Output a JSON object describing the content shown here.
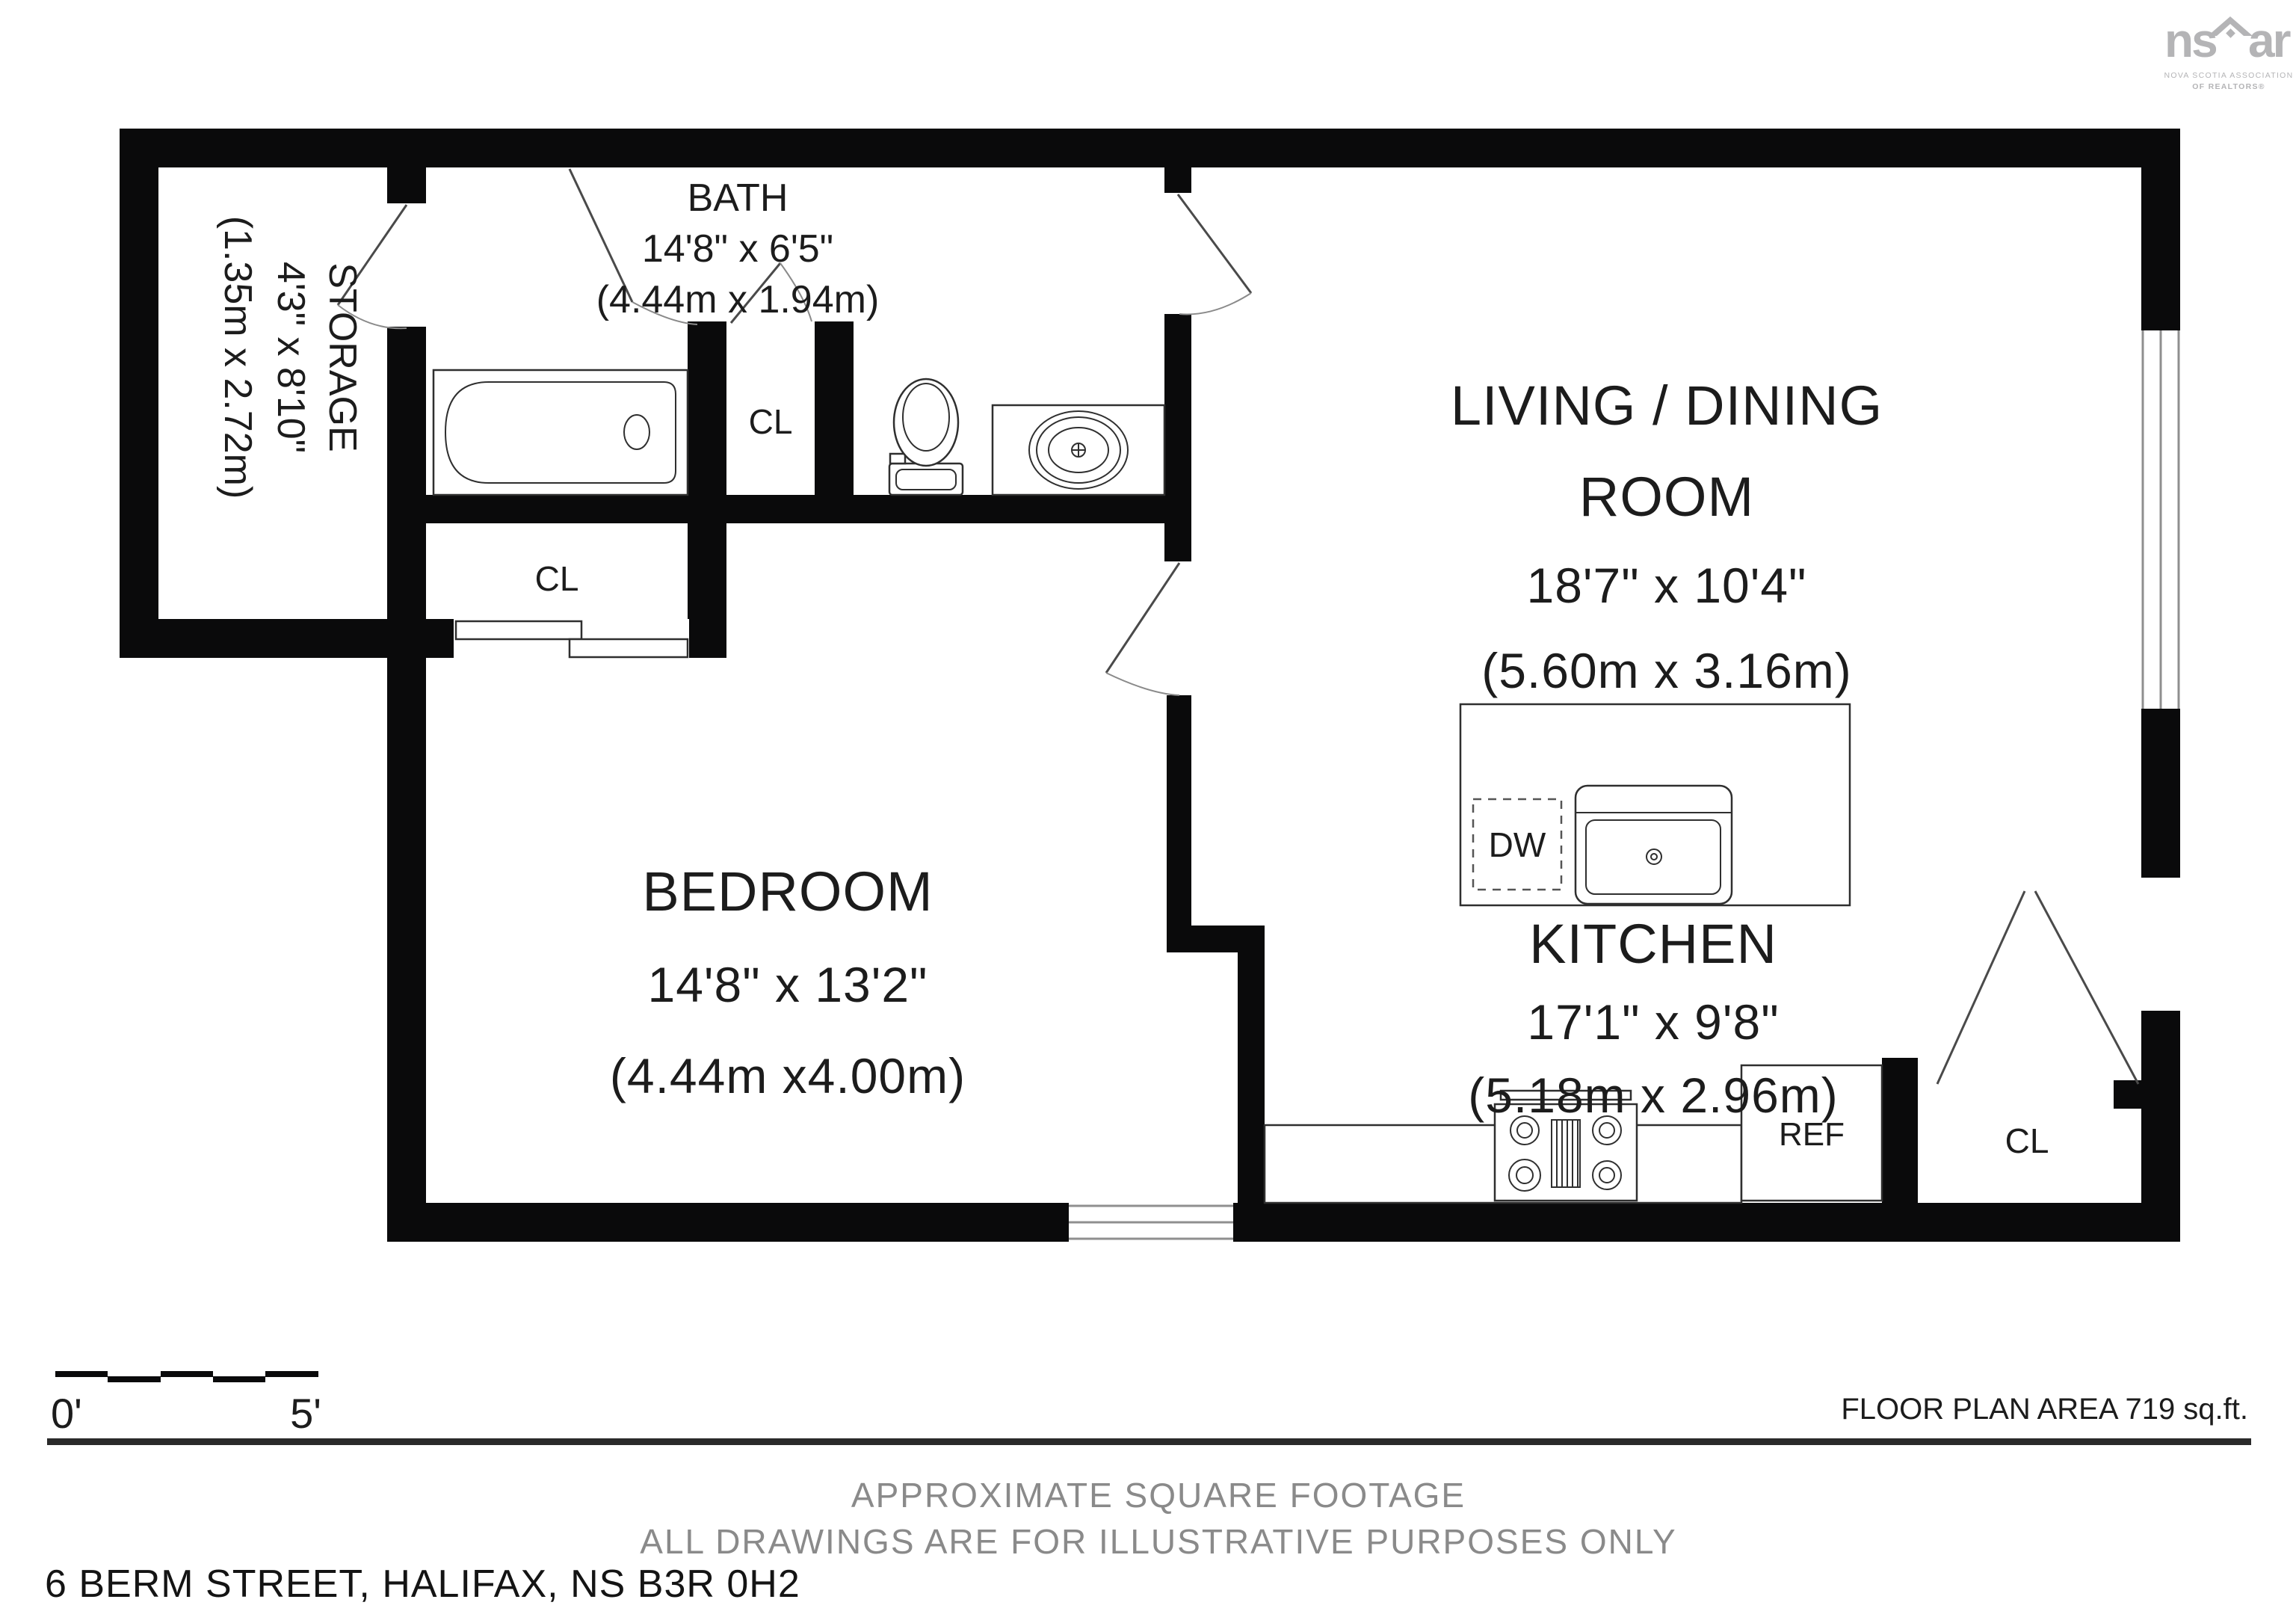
{
  "logo": {
    "prefix": "ns",
    "suffix": "ar",
    "tagline1": "NOVA SCOTIA ASSOCIATION",
    "tagline2": "OF REALTORS®"
  },
  "rooms": {
    "storage": {
      "name": "STORAGE",
      "dims": "4'3\" x 8'10\"",
      "metric": "(1.35m x 2.72m)"
    },
    "bath": {
      "name": "BATH",
      "dims": "14'8\" x 6'5\"",
      "metric": "(4.44m x 1.94m)"
    },
    "living": {
      "name": "LIVING / DINING",
      "name2": "ROOM",
      "dims": "18'7\" x 10'4\"",
      "metric": "(5.60m x 3.16m)"
    },
    "bedroom": {
      "name": "BEDROOM",
      "dims": "14'8\" x 13'2\"",
      "metric": "(4.44m x4.00m)"
    },
    "kitchen": {
      "name": "KITCHEN",
      "dims": "17'1\" x 9'8\"",
      "metric": "(5.18m x 2.96m)"
    }
  },
  "labels": {
    "closet_hall": "CL",
    "closet_bath": "CL",
    "closet_entry": "CL",
    "dishwasher": "DW",
    "fridge": "REF"
  },
  "scale_bar": {
    "start": "0'",
    "end": "5'"
  },
  "area_note": "FLOOR PLAN AREA 719 sq.ft.",
  "footer": {
    "line1": "APPROXIMATE SQUARE FOOTAGE",
    "line2": "ALL DRAWINGS ARE FOR ILLUSTRATIVE PURPOSES ONLY",
    "address": "6 BERM STREET, HALIFAX, NS B3R 0H2"
  },
  "colors": {
    "wall": "#0a0a0b",
    "text": "#1c1c1c",
    "muted": "#8a8a8a",
    "logo": "#b4b4b6"
  }
}
